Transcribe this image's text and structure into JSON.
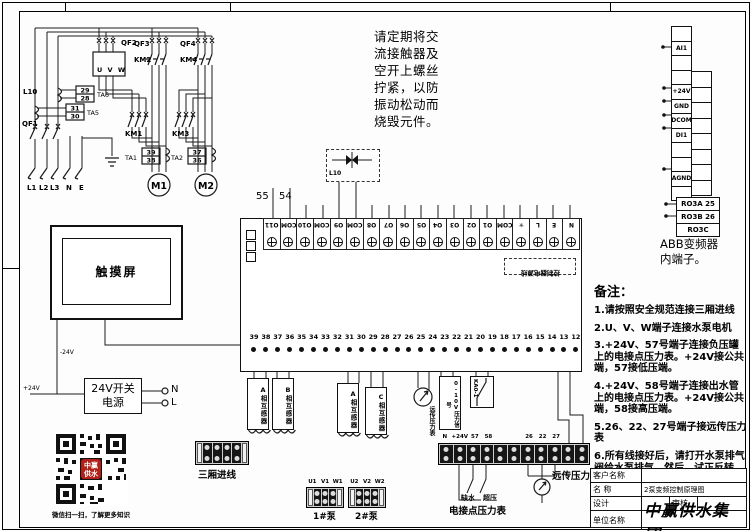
{
  "warning": {
    "lines": [
      "请定期将交",
      "流接触器及",
      "空开上螺丝",
      "拧紧，以防",
      "振动松动而",
      "烧毁元件。"
    ]
  },
  "power": {
    "qf1": "QF1",
    "qf2": "QF2",
    "qf3": "QF3",
    "qf4": "QF4",
    "km1": "KM1",
    "km2": "KM2",
    "km3": "KM3",
    "km4": "KM4",
    "vfd": "U V W",
    "l10": "L10",
    "cts": [
      {
        "name": "TA6",
        "top": "29",
        "bottom": "28"
      },
      {
        "name": "TA5",
        "top": "31",
        "bottom": "30"
      },
      {
        "name": "TA1",
        "top": "39",
        "bottom": "38"
      },
      {
        "name": "TA2",
        "top": "37",
        "bottom": "36"
      }
    ],
    "phases": [
      "L1",
      "L2",
      "L3",
      "N",
      "E"
    ],
    "motors": [
      "M1",
      "M2"
    ]
  },
  "tags": {
    "w55": "55",
    "w54": "54",
    "l10_box": "L10"
  },
  "controller": {
    "top_terminals": [
      "O11",
      "COM",
      "O10",
      "COM",
      "O9",
      "COM",
      "O8",
      "O7",
      "O6",
      "O5",
      "O4",
      "O3",
      "O2",
      "O1",
      "COM",
      "✳",
      "L",
      "E",
      "N"
    ],
    "power_note": "控制器电源线",
    "bottom_terminals": [
      "39",
      "38",
      "37",
      "36",
      "35",
      "34",
      "33",
      "32",
      "31",
      "30",
      "29",
      "28",
      "27",
      "26",
      "25",
      "24",
      "23",
      "22",
      "21",
      "20",
      "19",
      "18",
      "17",
      "16",
      "15",
      "14",
      "13",
      "12"
    ]
  },
  "below": {
    "cts": [
      "A相互感器",
      "B相互感器",
      "A相互感器",
      "C相互感器"
    ],
    "gauge": "远传压力表",
    "signal": "0-10V压力信号",
    "relay": "KA0-1"
  },
  "field": {
    "incoming": "三厢进线",
    "pump1_top": [
      "U1",
      "V1",
      "W1"
    ],
    "pump1": "1#泵",
    "pump2_top": [
      "U2",
      "V2",
      "W2"
    ],
    "pump2": "2#泵",
    "strip_labels": [
      "N",
      "+24V",
      "57",
      "58",
      "",
      "",
      "26",
      "22",
      "27",
      "",
      ""
    ],
    "low": "缺水",
    "high": "超压",
    "contact_gauge": "电接点压力表",
    "remote_gauge": "远传压力表"
  },
  "abb": {
    "left": [
      "",
      "AI1",
      "",
      "",
      "+24V",
      "GND",
      "DCOM",
      "DI1",
      "",
      "",
      "AGND",
      ""
    ],
    "ro": [
      "RO3A 25",
      "RO3B 26",
      "RO3C"
    ],
    "caption": [
      "ABB变频器",
      "内端子。"
    ]
  },
  "notes": {
    "title": "备注：",
    "items": [
      "1.请按照安全规范连接三厢进线",
      "2.U、V、W端子连接水泵电机",
      "3.+24V、57号端子连接负压罐上的电接点压力表。+24V接公共端，57接低压端。",
      "4.+24V、58号端子连接出水管上的电接点压力表。+24V接公共端，58接高压端。",
      "5.26、22、27号端子接远传压力表",
      "6.所有线接好后，请打开水泵排气阀给水泵排气，然后，试正反转。 最后，试机。"
    ]
  },
  "titleblock": {
    "customer": "客户名称",
    "customer_value": "",
    "name_label": "名  称",
    "name": "2泵变频控制原理图",
    "design": "设计",
    "design_value": "",
    "review": "审核",
    "review_value": "",
    "company_label": "单位名称",
    "company": "中赢供水集团"
  },
  "qr": {
    "caption": "微信扫一扫，了解更多知识",
    "logo1": "中赢",
    "logo2": "供水"
  },
  "hmi": {
    "label": "触摸屏"
  },
  "psu": {
    "label": "24V开关电源",
    "n": "N",
    "l": "L",
    "neg": "-24V",
    "pos": "+24V"
  }
}
